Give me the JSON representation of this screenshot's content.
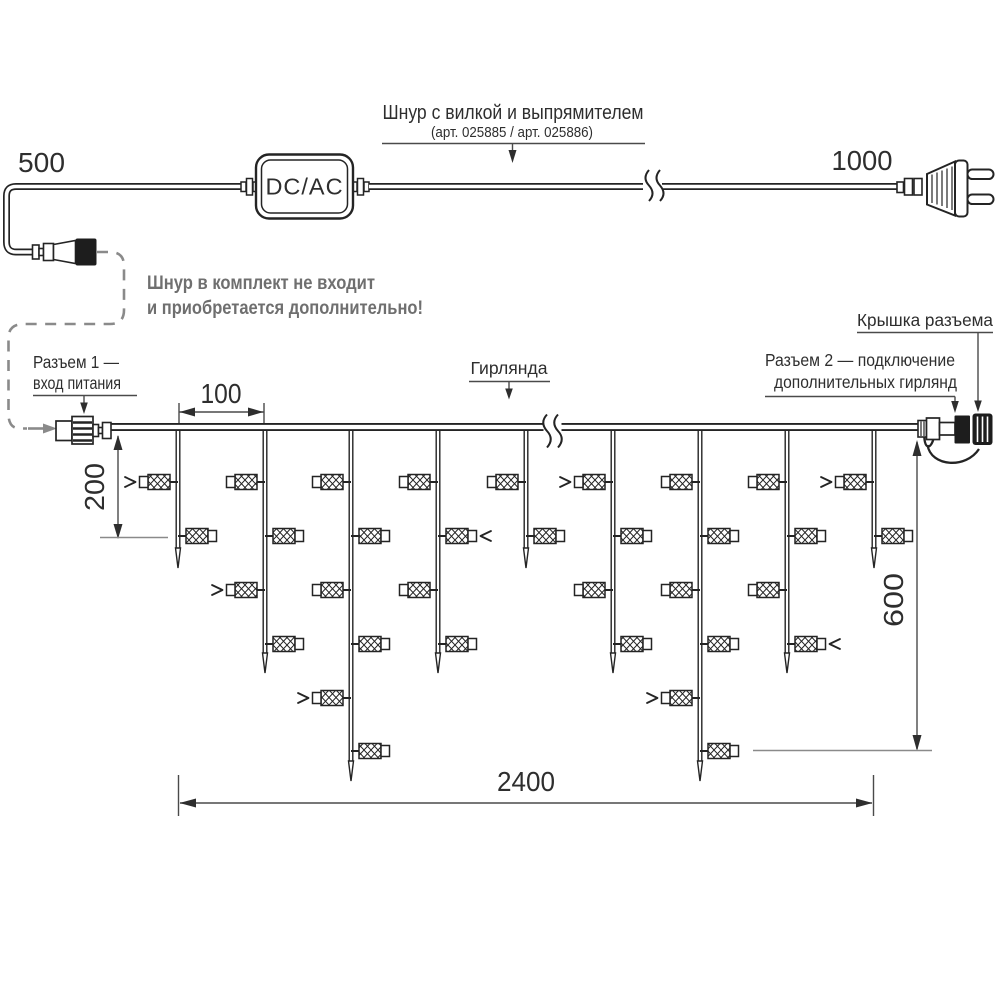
{
  "top_cord": {
    "length_left": "500",
    "length_right": "1000",
    "title": "Шнур с вилкой и выпрямителем",
    "subtitle": "(арт. 025885 /  арт. 025886)",
    "converter_label": "DC/AC",
    "note_line1": "Шнур в комплект не входит",
    "note_line2": "и приобретается дополнительно!"
  },
  "garland_section": {
    "connector1_line1": "Разъем 1 —",
    "connector1_line2": "вход питания",
    "garland_label": "Гирлянда",
    "connector2_line1": "Разъем 2 — подключение",
    "connector2_line2": "дополнительных гирлянд",
    "cap_label": "Крышка разъема",
    "dim_drop_spacing": "100",
    "dim_first_drop_height": "200",
    "dim_total_height": "600",
    "dim_total_length": "2400"
  },
  "colors": {
    "line": "#242424",
    "leader": "#4a4a4a",
    "gray": "#8a8a8a",
    "gray_text": "#6f6f6f",
    "background": "#ffffff"
  },
  "garland": {
    "wire_y": 427,
    "start_x": 110,
    "end_x": 918,
    "break_x": 552,
    "drops": [
      {
        "x": 178,
        "tip": 568,
        "bulbs": [
          {
            "side": "L",
            "y": 482,
            "arrow": true
          },
          {
            "side": "R",
            "y": 536
          }
        ]
      },
      {
        "x": 265,
        "tip": 673,
        "bulbs": [
          {
            "side": "L",
            "y": 482
          },
          {
            "side": "R",
            "y": 536
          },
          {
            "side": "L",
            "y": 590,
            "arrow": true
          },
          {
            "side": "R",
            "y": 644
          }
        ]
      },
      {
        "x": 351,
        "tip": 781,
        "bulbs": [
          {
            "side": "L",
            "y": 482
          },
          {
            "side": "R",
            "y": 536
          },
          {
            "side": "L",
            "y": 590
          },
          {
            "side": "R",
            "y": 644
          },
          {
            "side": "L",
            "y": 698,
            "arrow": true
          },
          {
            "side": "R",
            "y": 751
          }
        ]
      },
      {
        "x": 438,
        "tip": 673,
        "bulbs": [
          {
            "side": "L",
            "y": 482
          },
          {
            "side": "R",
            "y": 536,
            "arrow": true
          },
          {
            "side": "L",
            "y": 590
          },
          {
            "side": "R",
            "y": 644
          }
        ]
      },
      {
        "x": 526,
        "tip": 568,
        "bulbs": [
          {
            "side": "L",
            "y": 482
          },
          {
            "side": "R",
            "y": 536
          }
        ]
      },
      {
        "x": 613,
        "tip": 673,
        "bulbs": [
          {
            "side": "L",
            "y": 482,
            "arrow": true
          },
          {
            "side": "R",
            "y": 536
          },
          {
            "side": "L",
            "y": 590
          },
          {
            "side": "R",
            "y": 644
          }
        ]
      },
      {
        "x": 700,
        "tip": 781,
        "bulbs": [
          {
            "side": "L",
            "y": 482
          },
          {
            "side": "R",
            "y": 536
          },
          {
            "side": "L",
            "y": 590
          },
          {
            "side": "R",
            "y": 644
          },
          {
            "side": "L",
            "y": 698,
            "arrow": true
          },
          {
            "side": "R",
            "y": 751
          }
        ]
      },
      {
        "x": 787,
        "tip": 673,
        "bulbs": [
          {
            "side": "L",
            "y": 482
          },
          {
            "side": "R",
            "y": 536
          },
          {
            "side": "L",
            "y": 590
          },
          {
            "side": "R",
            "y": 644,
            "arrow": true
          }
        ]
      },
      {
        "x": 874,
        "tip": 568,
        "bulbs": [
          {
            "side": "L",
            "y": 482,
            "arrow": true
          },
          {
            "side": "R",
            "y": 536
          }
        ]
      }
    ]
  }
}
